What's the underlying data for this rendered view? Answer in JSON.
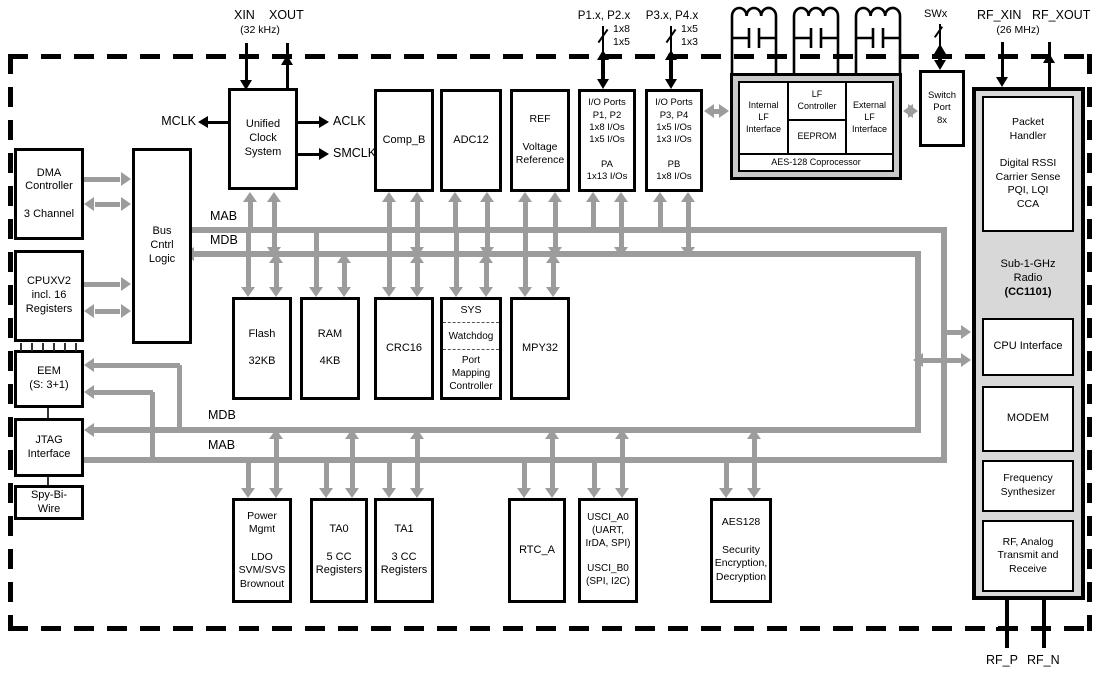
{
  "pins": {
    "xin": "XIN",
    "xout": "XOUT",
    "xtal_freq": "(32 kHz)",
    "p12_label": "P1.x, P2.x",
    "p12_w1": "1x8",
    "p12_w2": "1x5",
    "p34_label": "P3.x, P4.x",
    "p34_w1": "1x5",
    "p34_w2": "1x3",
    "swx": "SWx",
    "rf_xin": "RF_XIN",
    "rf_xout": "RF_XOUT",
    "rf_freq": "(26 MHz)",
    "rf_p": "RF_P",
    "rf_n": "RF_N"
  },
  "clocks": {
    "mclk": "MCLK",
    "aclk": "ACLK",
    "smclk": "SMCLK"
  },
  "buses": {
    "mab": "MAB",
    "mdb": "MDB"
  },
  "blocks": {
    "dma": "DMA\nController\n\n3 Channel",
    "bus_ctrl": "Bus\nCntrl\nLogic",
    "cpu": "CPUXV2\nincl. 16\nRegisters",
    "eem": "EEM\n(S: 3+1)",
    "jtag": "JTAG\nInterface",
    "spy_bi_wire": "Spy-Bi-\nWire",
    "ucs": "Unified\nClock\nSystem",
    "comp_b": "Comp_B",
    "adc12": "ADC12",
    "ref": "REF\n\nVoltage\nReference",
    "io_p1p2": "I/O Ports\nP1, P2\n1x8 I/Os\n1x5 I/Os\n\nPA\n1x13 I/Os",
    "io_p3p4": "I/O Ports\nP3, P4\n1x5 I/Os\n1x3 I/Os\n\nPB\n1x8 I/Os",
    "flash": "Flash\n\n32KB",
    "ram": "RAM\n\n4KB",
    "crc16": "CRC16",
    "sys": "SYS",
    "watchdog": "Watchdog",
    "port_mapping": "Port\nMapping\nController",
    "mpy32": "MPY32",
    "power_mgmt": "Power\nMgmt\n\nLDO\nSVM/SVS\nBrownout",
    "ta0": "TA0\n\n5 CC\nRegisters",
    "ta1": "TA1\n\n3 CC\nRegisters",
    "rtc_a": "RTC_A",
    "usci": "USCI_A0\n(UART,\nIrDA, SPI)\n\nUSCI_B0\n(SPI, I2C)",
    "aes128": "AES128\n\nSecurity\nEncryption,\nDecryption"
  },
  "lf_module": {
    "internal": "Internal\nLF\nInterface",
    "controller": "LF\nController",
    "eeprom": "EEPROM",
    "external": "External\nLF\nInterface",
    "caption": "AES-128 Coprocessor"
  },
  "switch_port": "Switch\nPort\n8x",
  "radio": {
    "packet_handler": "Packet\nHandler\n\nDigital RSSI\nCarrier Sense\nPQI, LQI\nCCA",
    "name": "Sub-1-GHz\nRadio",
    "part": "(CC1101)",
    "cpu_interface": "CPU Interface",
    "modem": "MODEM",
    "synthesizer": "Frequency\nSynthesizer",
    "rf_analog": "RF, Analog\nTransmit and\nReceive"
  },
  "colors": {
    "arrow_gray": "#9c9c9c",
    "module_gray": "#c9c9c9",
    "radio_gray": "#d8d8d8"
  }
}
